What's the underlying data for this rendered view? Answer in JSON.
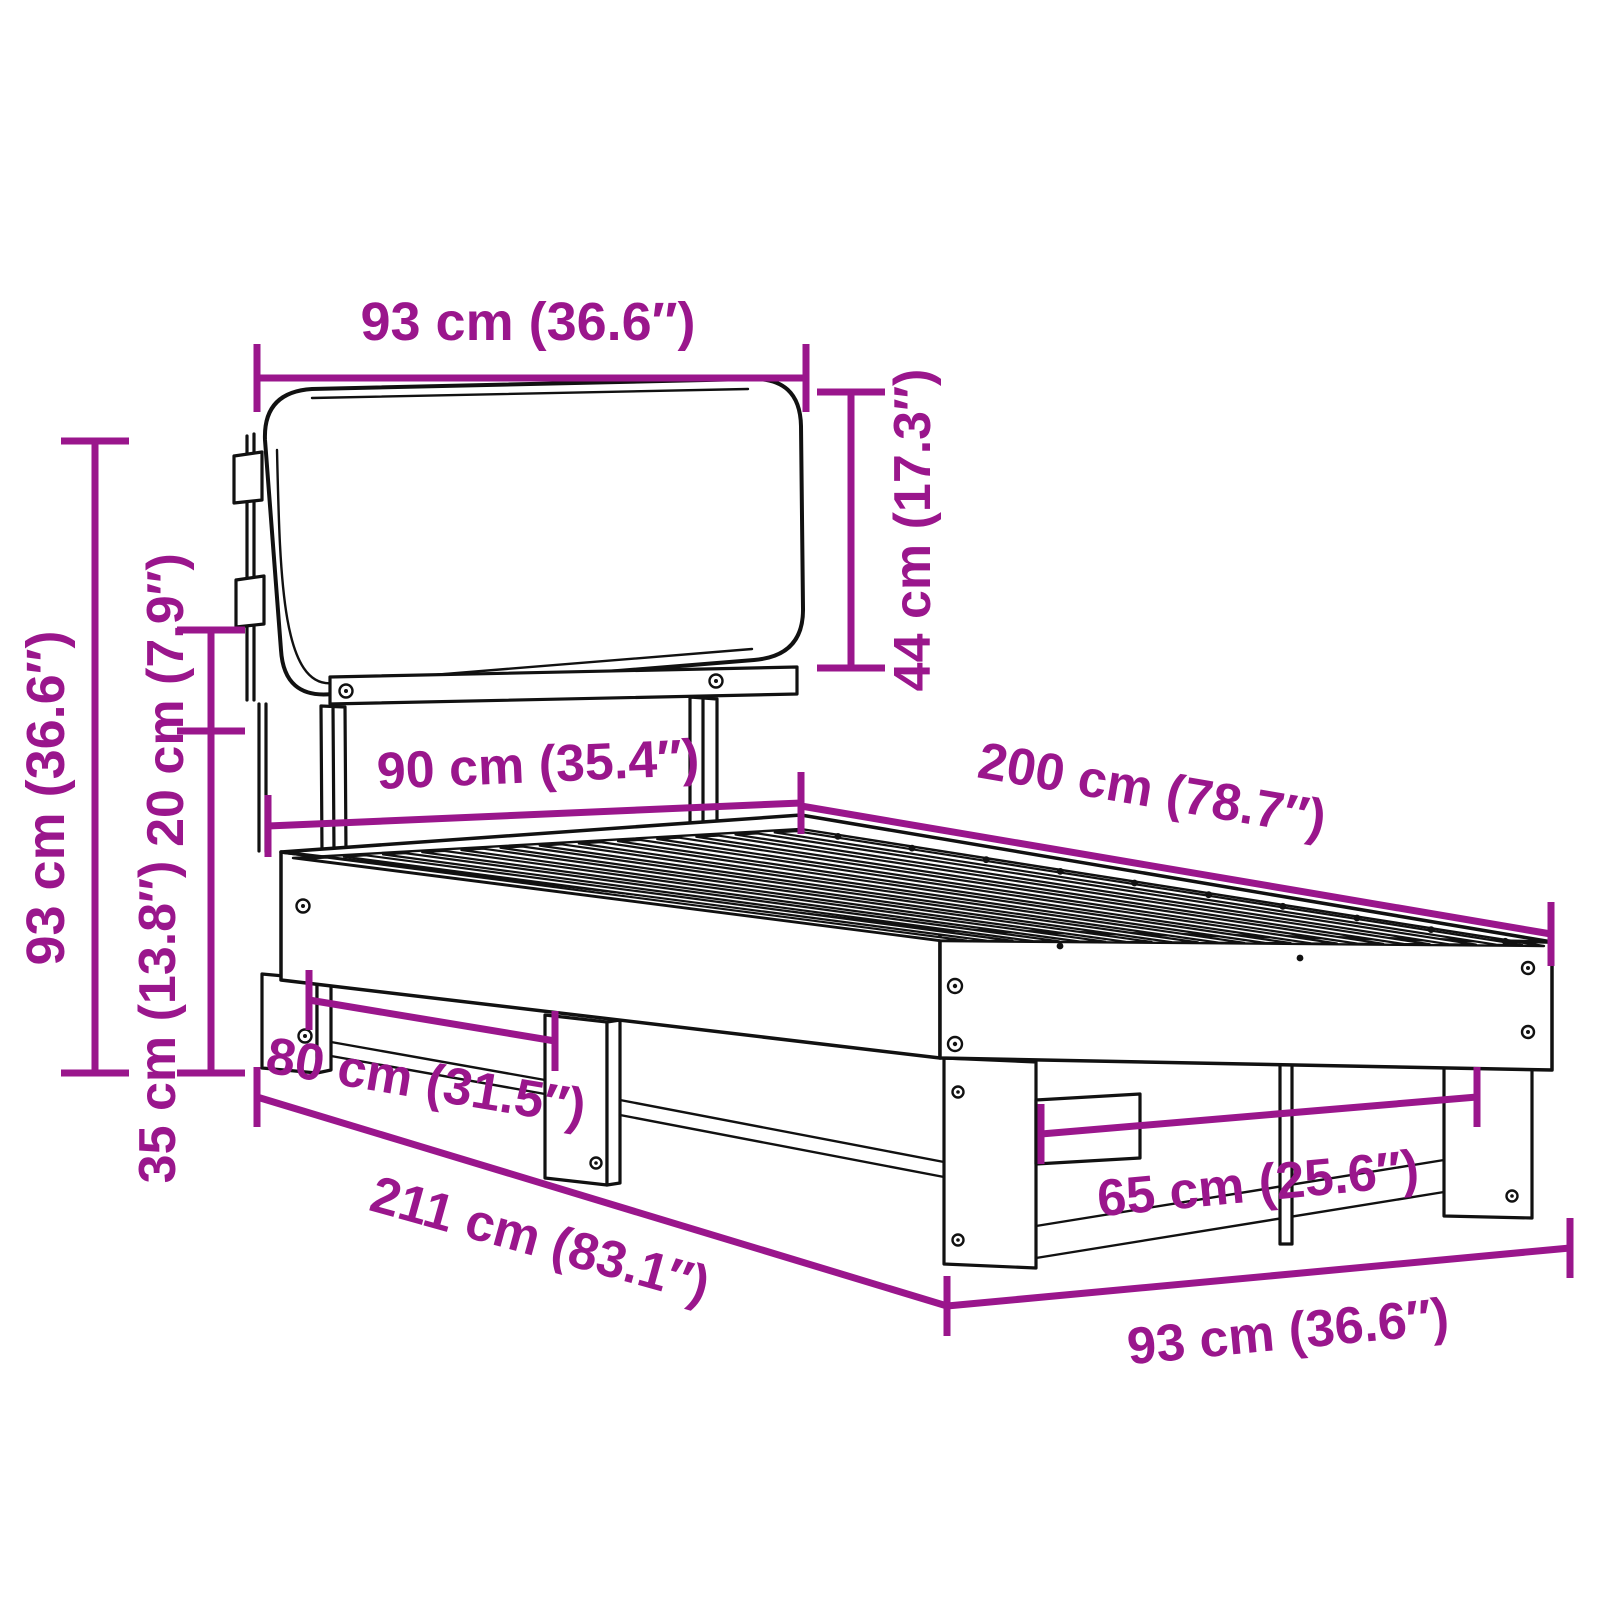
{
  "diagram": {
    "type": "furniture-dimension-diagram",
    "subject": "pallet bed frame with cushioned headboard",
    "background": "#ffffff",
    "colors": {
      "dimension": "#9a168c",
      "line": "#111111"
    },
    "units": [
      "cm",
      "inches"
    ]
  },
  "dims": {
    "headboard_width": {
      "label": "93 cm (36.6″)"
    },
    "headboard_height": {
      "label": "44 cm (17.3″)"
    },
    "overall_height": {
      "label": "93 cm (36.6″)"
    },
    "headboard_overlap": {
      "label": "20 cm (7.9″)"
    },
    "frame_height": {
      "label": "35 cm (13.8″)"
    },
    "bed_width": {
      "label": "90 cm (35.4″)"
    },
    "bed_length": {
      "label": "200 cm (78.7″)"
    },
    "front_leg_spacing": {
      "label": "80 cm (31.5″)"
    },
    "overall_length": {
      "label": "211 cm (83.1″)"
    },
    "foot_leg_spacing": {
      "label": "65 cm (25.6″)"
    },
    "overall_width": {
      "label": "93 cm (36.6″)"
    }
  }
}
